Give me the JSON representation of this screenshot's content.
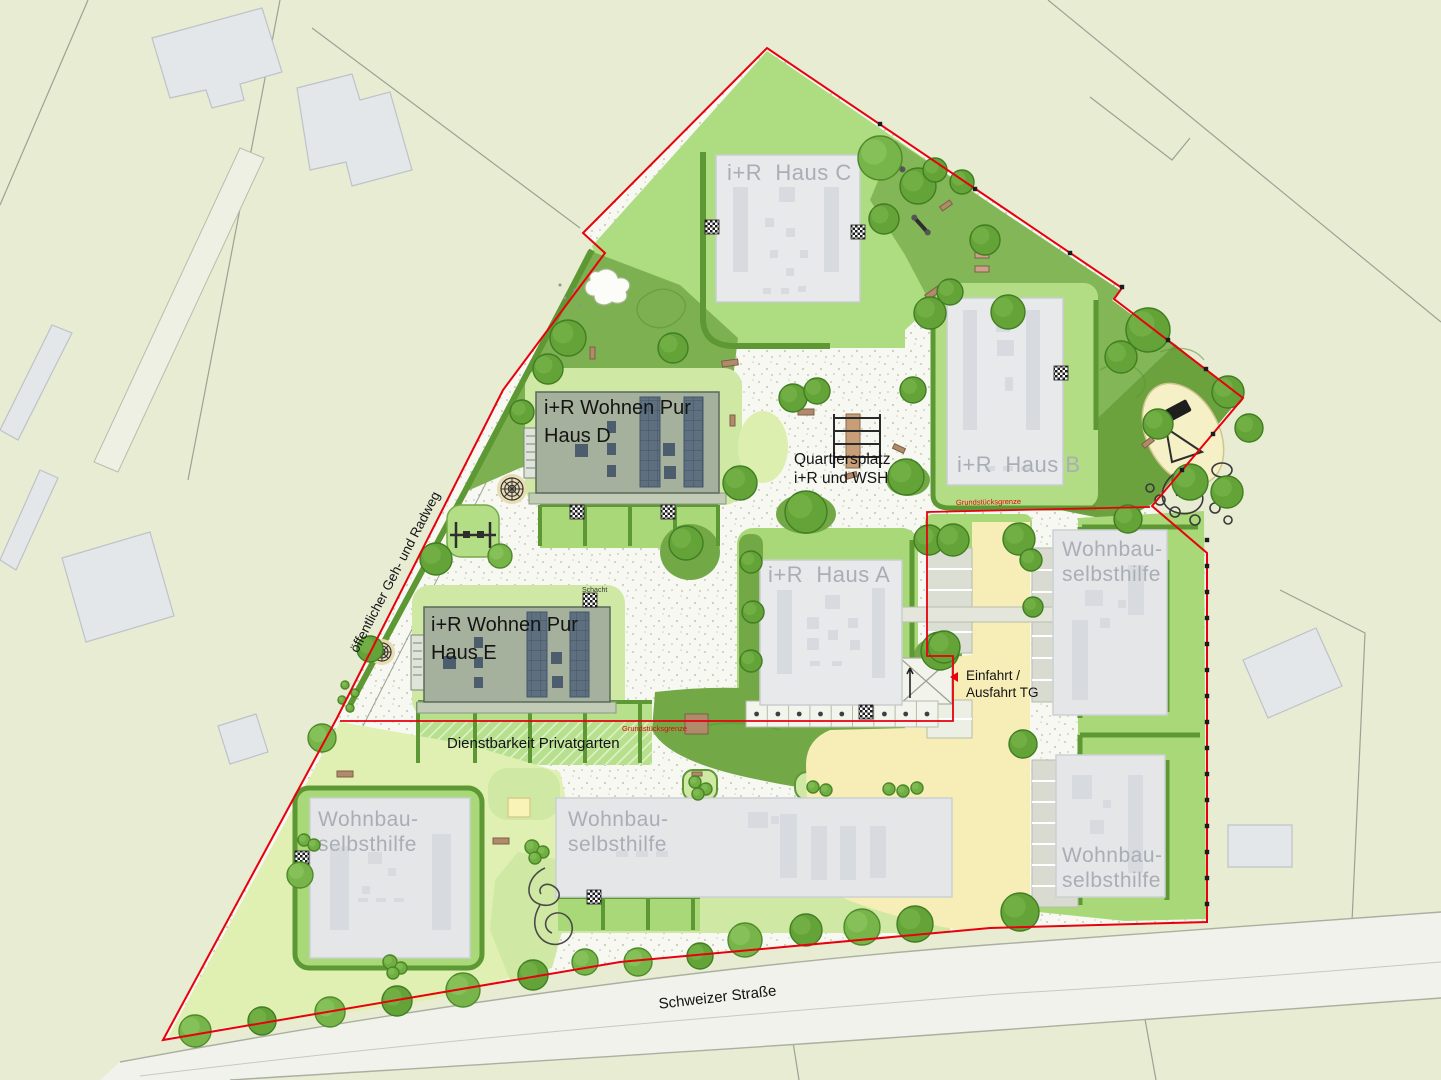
{
  "title": "Site plan residential quarter",
  "labels": {
    "haus_c": "i+R  Haus C",
    "haus_b": "i+R  Haus B",
    "haus_a": "i+R  Haus A",
    "wohnen_pur": "i+R Wohnen Pur",
    "haus_d": "Haus D",
    "haus_e": "Haus E",
    "quartiersplatz_1": "Quartiersplatz",
    "quartiersplatz_2": "i+R und WSH",
    "wohnbau_1": "Wohnbau-",
    "wohnbau_2": "selbsthilfe",
    "einfahrt_1": "Einfahrt /",
    "einfahrt_2": "Ausfahrt TG",
    "dienstbarkeit": "Dienstbarkeit Privatgarten",
    "gehweg": "öffentlicher Geh- und Radweg",
    "strasse": "Schweizer Straße",
    "grenze": "Grundstücksgrenze",
    "schacht": "Schacht"
  },
  "colors": {
    "boundary_red": "#e8000e",
    "surroundings": "#e8ecd3",
    "path_white": "#f7f8f1",
    "lawn_pale": "#dff0b2",
    "lawn_light": "#cfe9a4",
    "lawn_bright": "#a9d878",
    "garden_bright": "#b2dd84",
    "meadow_dark": "#7db050",
    "playground_dark": "#6ba23e",
    "hedge": "#5d9834",
    "drive_yellow": "#f6eeb6",
    "sand": "#f6f0c6",
    "building_grey": "#e6e8ea",
    "building_green_grey": "#a6b19d",
    "solar_panel": "#5e7080",
    "bench_brown": "#b08a6b",
    "label_grey": "#a9aeb6"
  }
}
